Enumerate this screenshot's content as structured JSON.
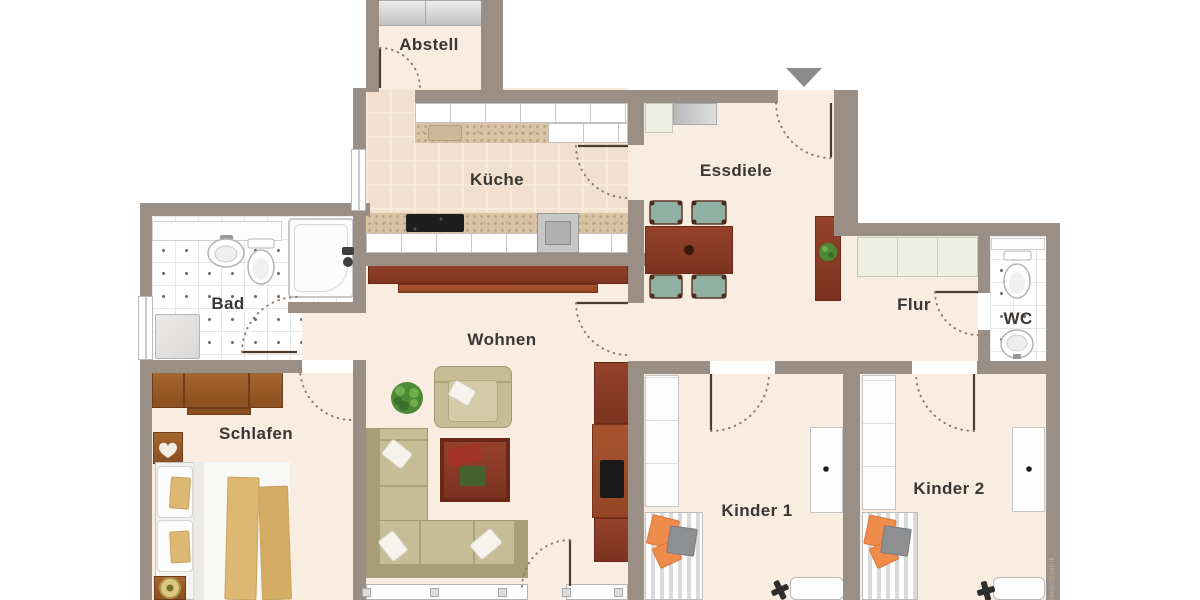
{
  "plan": {
    "rooms": {
      "abstell": "Abstell",
      "kueche": "Küche",
      "essdiele": "Essdiele",
      "bad": "Bad",
      "wohnen": "Wohnen",
      "flur": "Flur",
      "wc": "WC",
      "schlafen": "Schlafen",
      "kinder1": "Kinder 1",
      "kinder2": "Kinder 2"
    },
    "watermark": "ImmoGraFik",
    "colors": {
      "wall": "#9b8e85",
      "floor": "#f9ece1",
      "kitchen_tile": "#f2dfcd",
      "bath_tile": "#ffffff",
      "wood_dark": "#8e3c26",
      "wardrobe_brown": "#9a5c2a",
      "sofa_beige": "#c6bc96",
      "accent_orange": "#ef8c4c",
      "counter_speckle": "#d8c3a5",
      "entrance_arrow": "#8c8c8c",
      "label_text": "#3a3633"
    }
  }
}
